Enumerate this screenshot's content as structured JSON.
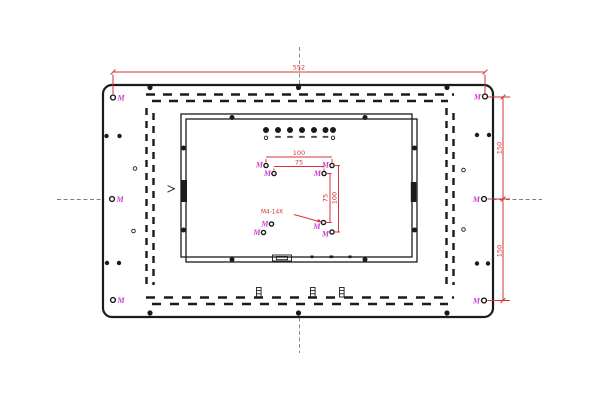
{
  "dimensions": {
    "top_width": "552",
    "right_upper_height": "150",
    "right_lower_height": "150",
    "vesa_outer_width": "100",
    "vesa_inner_width": "75",
    "vesa_inner_height": "75",
    "vesa_outer_height": "100"
  },
  "callouts": {
    "vesa_thread": "M4-14X"
  },
  "labels": {
    "mount_hole": "M"
  },
  "osd": {
    "button_count": 7
  },
  "colors": {
    "red": "#d23636",
    "magenta": "#c93fc9",
    "line": "#1b1b1b",
    "gray": "#7e7e7e"
  }
}
